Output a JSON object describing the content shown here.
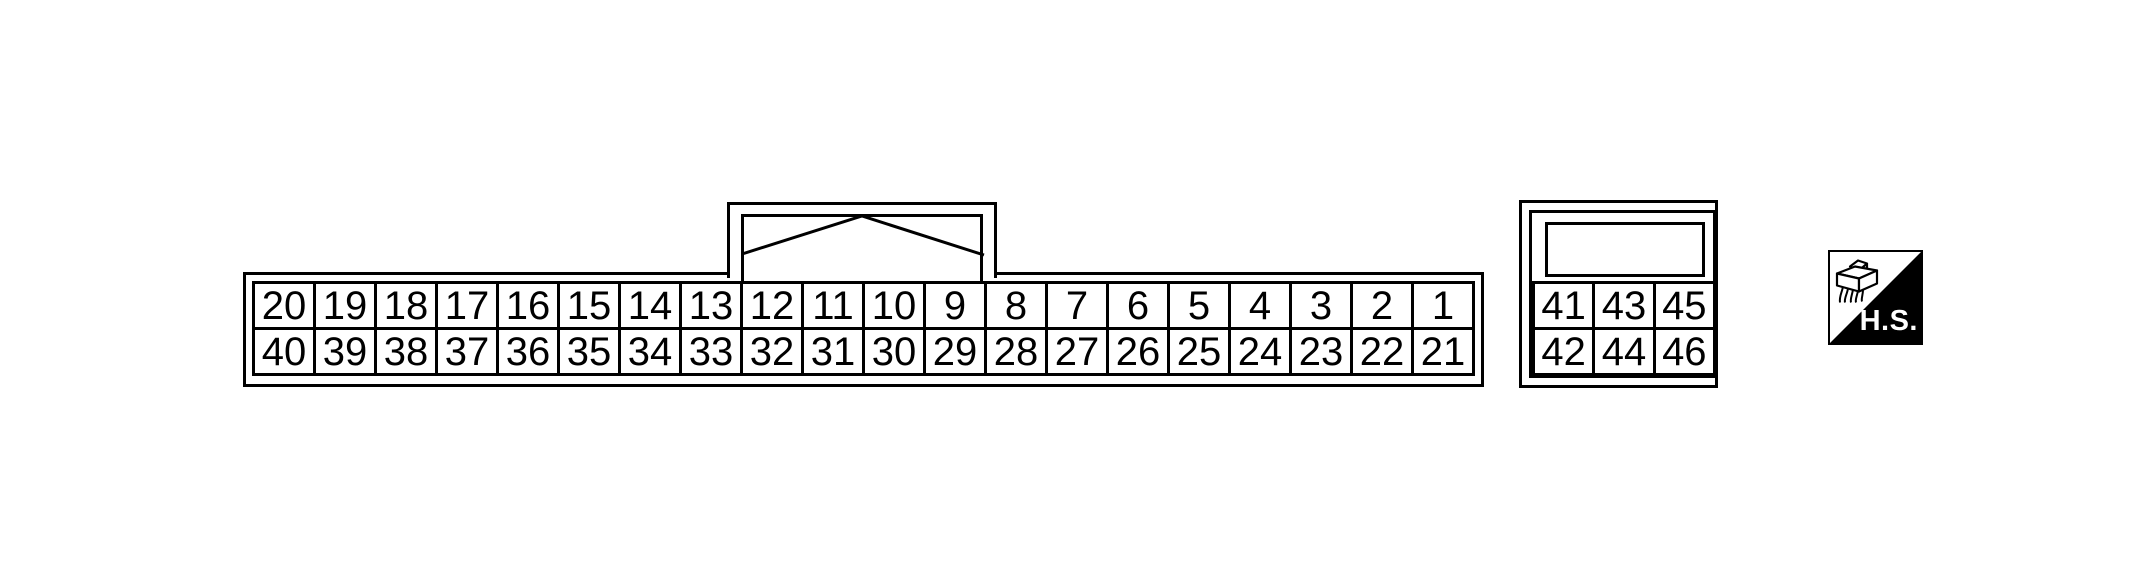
{
  "colors": {
    "line": "#000000",
    "background": "#ffffff",
    "badge_fill": "#000000",
    "badge_text": "#ffffff"
  },
  "main_connector": {
    "top_row": [
      "20",
      "19",
      "18",
      "17",
      "16",
      "15",
      "14",
      "13",
      "12",
      "11",
      "10",
      "9",
      "8",
      "7",
      "6",
      "5",
      "4",
      "3",
      "2",
      "1"
    ],
    "bottom_row": [
      "40",
      "39",
      "38",
      "37",
      "36",
      "35",
      "34",
      "33",
      "32",
      "31",
      "30",
      "29",
      "28",
      "27",
      "26",
      "25",
      "24",
      "23",
      "22",
      "21"
    ]
  },
  "aux_connector": {
    "top_row": [
      "41",
      "43",
      "45"
    ],
    "bottom_row": [
      "42",
      "44",
      "46"
    ]
  },
  "hs_badge": {
    "label": "H.S.",
    "icon": "harness-connector-icon"
  }
}
